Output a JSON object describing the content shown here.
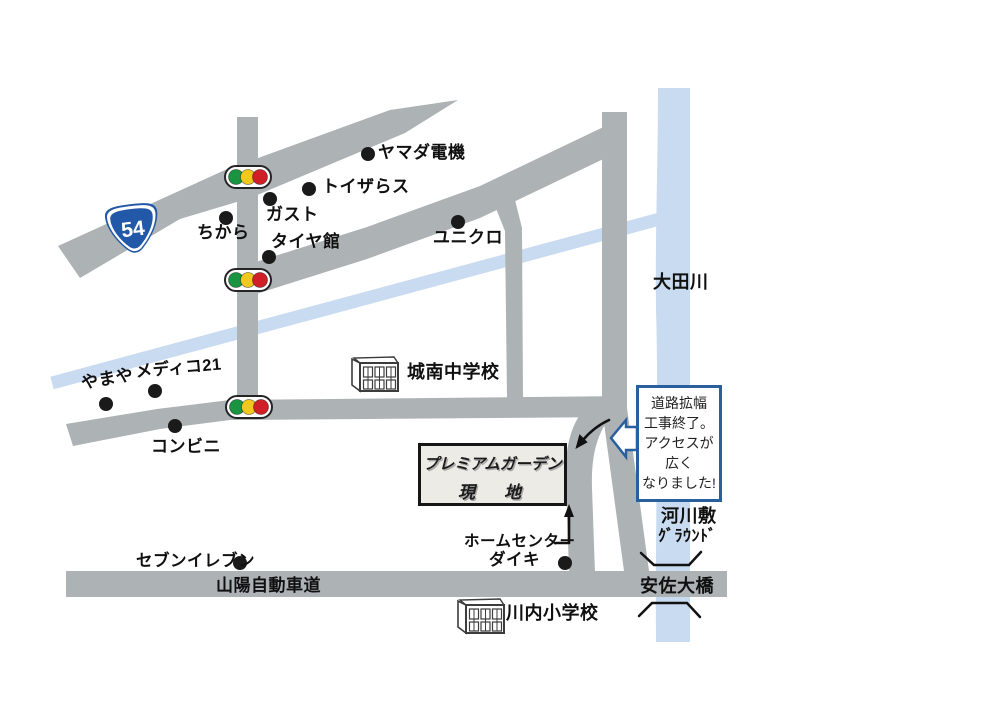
{
  "colors": {
    "road": "#adb2b5",
    "water": "#c9dbf0",
    "ink": "#111111",
    "signal_green": "#1a9440",
    "signal_yellow": "#f2c71e",
    "signal_red": "#d01f27",
    "route_badge_blue": "#2258a8",
    "bubble_border": "#2a5f9e",
    "site_box_fill": "#edebe6"
  },
  "route_badge": {
    "number": "54"
  },
  "labels": {
    "yamada_denki": "ヤマダ電機",
    "toizarasu": "トイザらス",
    "gasuto": "ガスト",
    "chikara": "ちから",
    "taiyakan": "タイヤ館",
    "uniqlo": "ユニクロ",
    "otagawa": "大田川",
    "jonan_chugakko": "城南中学校",
    "mediko21": "メディコ21",
    "yamaya": "やまや",
    "konbini": "コンビニ",
    "seven_eleven": "セブンイレブン",
    "home_center": "ホームセンター",
    "daiki": "ダイキ",
    "sanyo_jidoshado": "山陽自動車道",
    "asa_ohashi": "安佐大橋",
    "kasenjiki_line1": "河川敷",
    "kasenjiki_line2": "ｸﾞﾗｳﾝﾄﾞ",
    "kawauchi_shogakko": "川内小学校"
  },
  "site_box": {
    "line1": "プレミアムガーデン",
    "line2": "現　地"
  },
  "notice_bubble": {
    "line1": "道路拡幅",
    "line2": "工事終了。",
    "line3": "アクセスが",
    "line4": "広く",
    "line5": "なりました!"
  },
  "icons": {
    "traffic_light": "traffic-light",
    "school": "school-building",
    "dot": "landmark-dot",
    "route_shield": "route-54-shield",
    "callout": "callout-arrow-left",
    "arrow_up": "up-arrow",
    "arrow_curve": "down-left-arrow",
    "riverbank": "riverbank-brackets"
  }
}
